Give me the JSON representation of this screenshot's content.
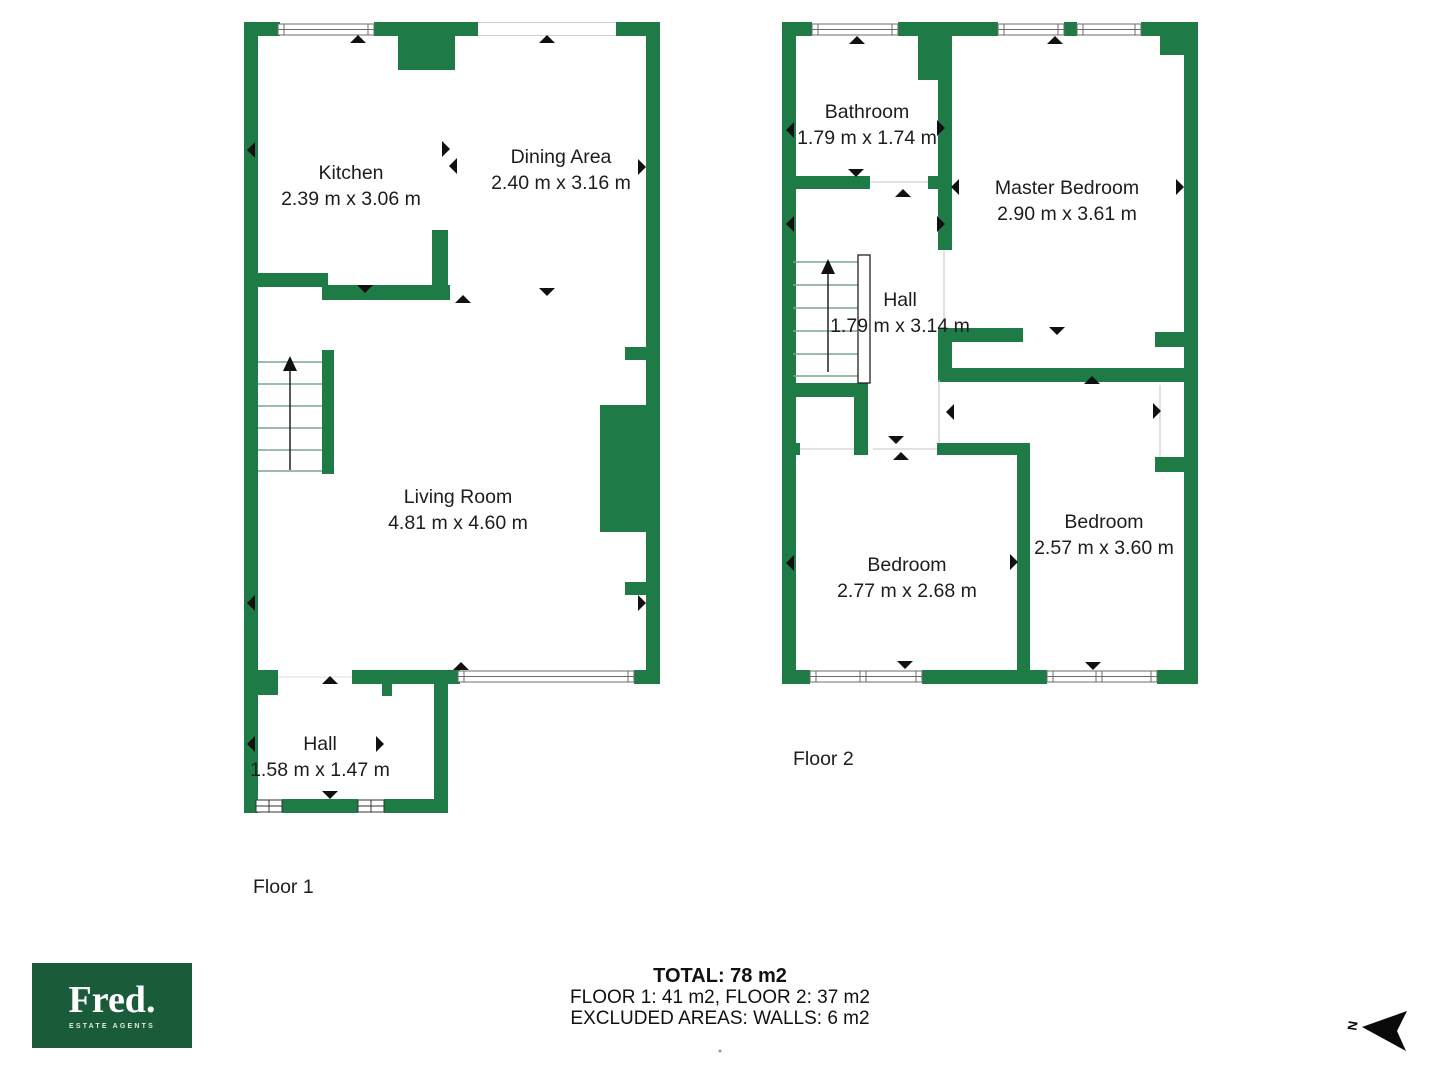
{
  "floor1": {
    "label": "Floor 1",
    "rooms": {
      "kitchen": {
        "name": "Kitchen",
        "dims": "2.39 m x 3.06 m"
      },
      "dining": {
        "name": "Dining Area",
        "dims": "2.40 m x 3.16 m"
      },
      "living": {
        "name": "Living Room",
        "dims": "4.81 m x 4.60 m"
      },
      "hall": {
        "name": "Hall",
        "dims": "1.58 m x 1.47 m"
      }
    }
  },
  "floor2": {
    "label": "Floor 2",
    "rooms": {
      "bathroom": {
        "name": "Bathroom",
        "dims": "1.79 m x 1.74 m"
      },
      "master": {
        "name": "Master Bedroom",
        "dims": "2.90 m x 3.61 m"
      },
      "hall": {
        "name": "Hall",
        "dims": "1.79 m x 3.14 m"
      },
      "bedroom_left": {
        "name": "Bedroom",
        "dims": "2.77 m x 2.68 m"
      },
      "bedroom_right": {
        "name": "Bedroom",
        "dims": "2.57 m x 3.60 m"
      }
    }
  },
  "summary": {
    "total": "TOTAL: 78 m2",
    "floors": "FLOOR 1: 41 m2, FLOOR 2: 37 m2",
    "excluded": "EXCLUDED AREAS: WALLS: 6 m2"
  },
  "logo": {
    "brand": "Fred.",
    "tagline": "ESTATE AGENTS"
  },
  "compass": {
    "label": "N"
  },
  "colors": {
    "wall": "#1e7b46",
    "logo_bg": "#1a5c39",
    "tread": "#79a58c",
    "window_stroke": "#6b6b6b",
    "arrow": "#111111",
    "text": "#1d1d1d"
  }
}
